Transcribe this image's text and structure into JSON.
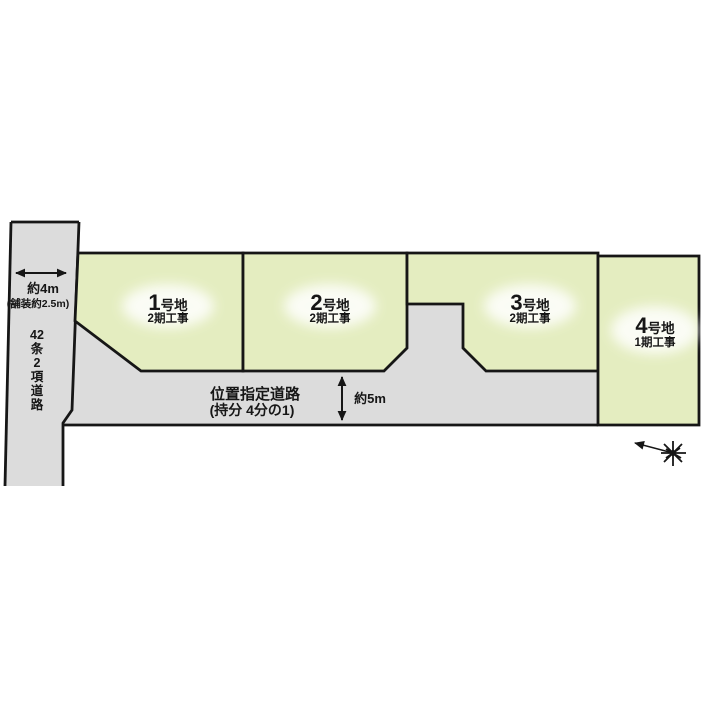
{
  "diagram": {
    "title": "宅地区画図",
    "colors": {
      "plot_fill": "#e4edc0",
      "road_fill": "#dcdcdc",
      "line": "#161616",
      "background": "#ffffff"
    },
    "plots": [
      {
        "number": "1",
        "suffix": "号地",
        "phase": "2期工事"
      },
      {
        "number": "2",
        "suffix": "号地",
        "phase": "2期工事"
      },
      {
        "number": "3",
        "suffix": "号地",
        "phase": "2期工事"
      },
      {
        "number": "4",
        "suffix": "号地",
        "phase": "1期工事"
      }
    ],
    "side_road": {
      "width_label": "約4m",
      "paving_label": "(舗装約2.5m)",
      "name_vertical": [
        "42",
        "条",
        "2",
        "項",
        "道",
        "路"
      ]
    },
    "front_road": {
      "name": "位置指定道路",
      "ownership": "(持分 4分の1)",
      "width_label": "約5m"
    },
    "icons": {
      "north_arrow": "starburst with long arrow pointing upper-left"
    }
  }
}
